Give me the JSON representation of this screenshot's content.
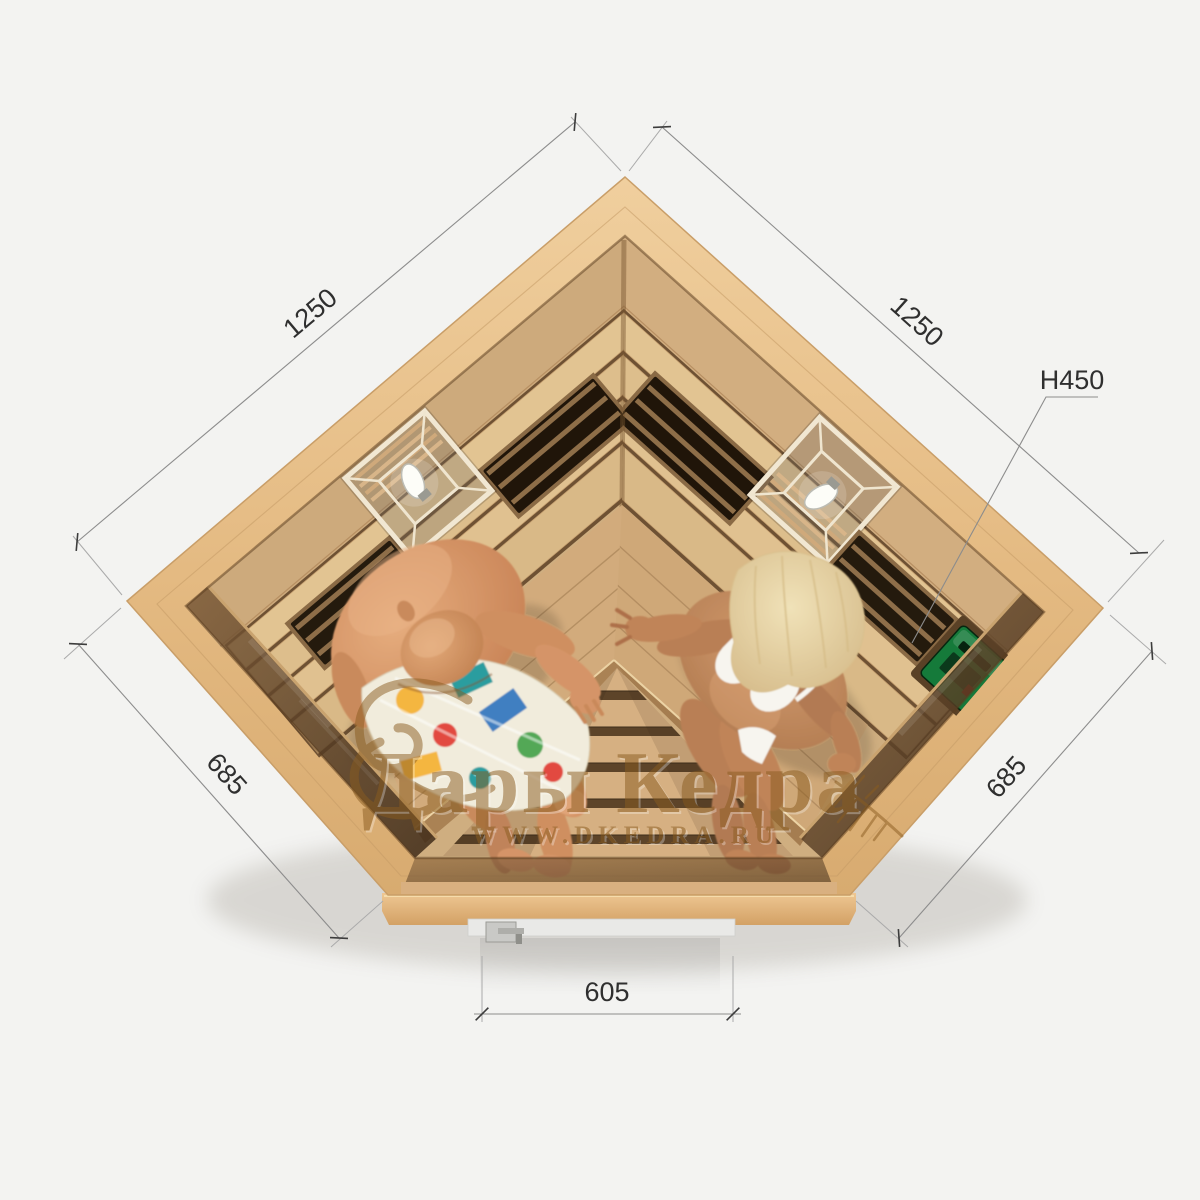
{
  "title": "Corner infrared sauna for two persons — top view product render",
  "background": "#f3f3f1",
  "watermark": {
    "brand": "Дары Кедра",
    "website": "WWW.DKEDRA.RU",
    "color": "#8a5c20"
  },
  "dimensions": {
    "left_wall": "1250",
    "right_wall": "1250",
    "height": "H450",
    "left_front": "685",
    "right_front": "685",
    "door": "605"
  },
  "colors": {
    "wood_cap": "#e6c08c",
    "wood_interior": "#d3ae7f",
    "bench": "#d0a97b",
    "floor": "#d6b082",
    "glass": "#4e3620",
    "heater_vent": "#201509",
    "control_panel": "#157a3a",
    "dimension_lines": "#8c8c8c",
    "dimension_text": "#2f2f2f",
    "skin_man": "#d59468",
    "skin_woman": "#bd8458",
    "hair_woman": "#e9d7a8",
    "swimsuit_white": "#f7f5ef"
  },
  "objects": {
    "lamp_left": "corner lantern lamp",
    "lamp_right": "corner lantern lamp",
    "heater_panels": "infrared heater vents behind backrest slats",
    "control_panel": "green sauna control unit on right wall",
    "door_handle": "glass door handle",
    "man": "man in multicolor swim shorts",
    "woman": "woman in white bikini"
  }
}
